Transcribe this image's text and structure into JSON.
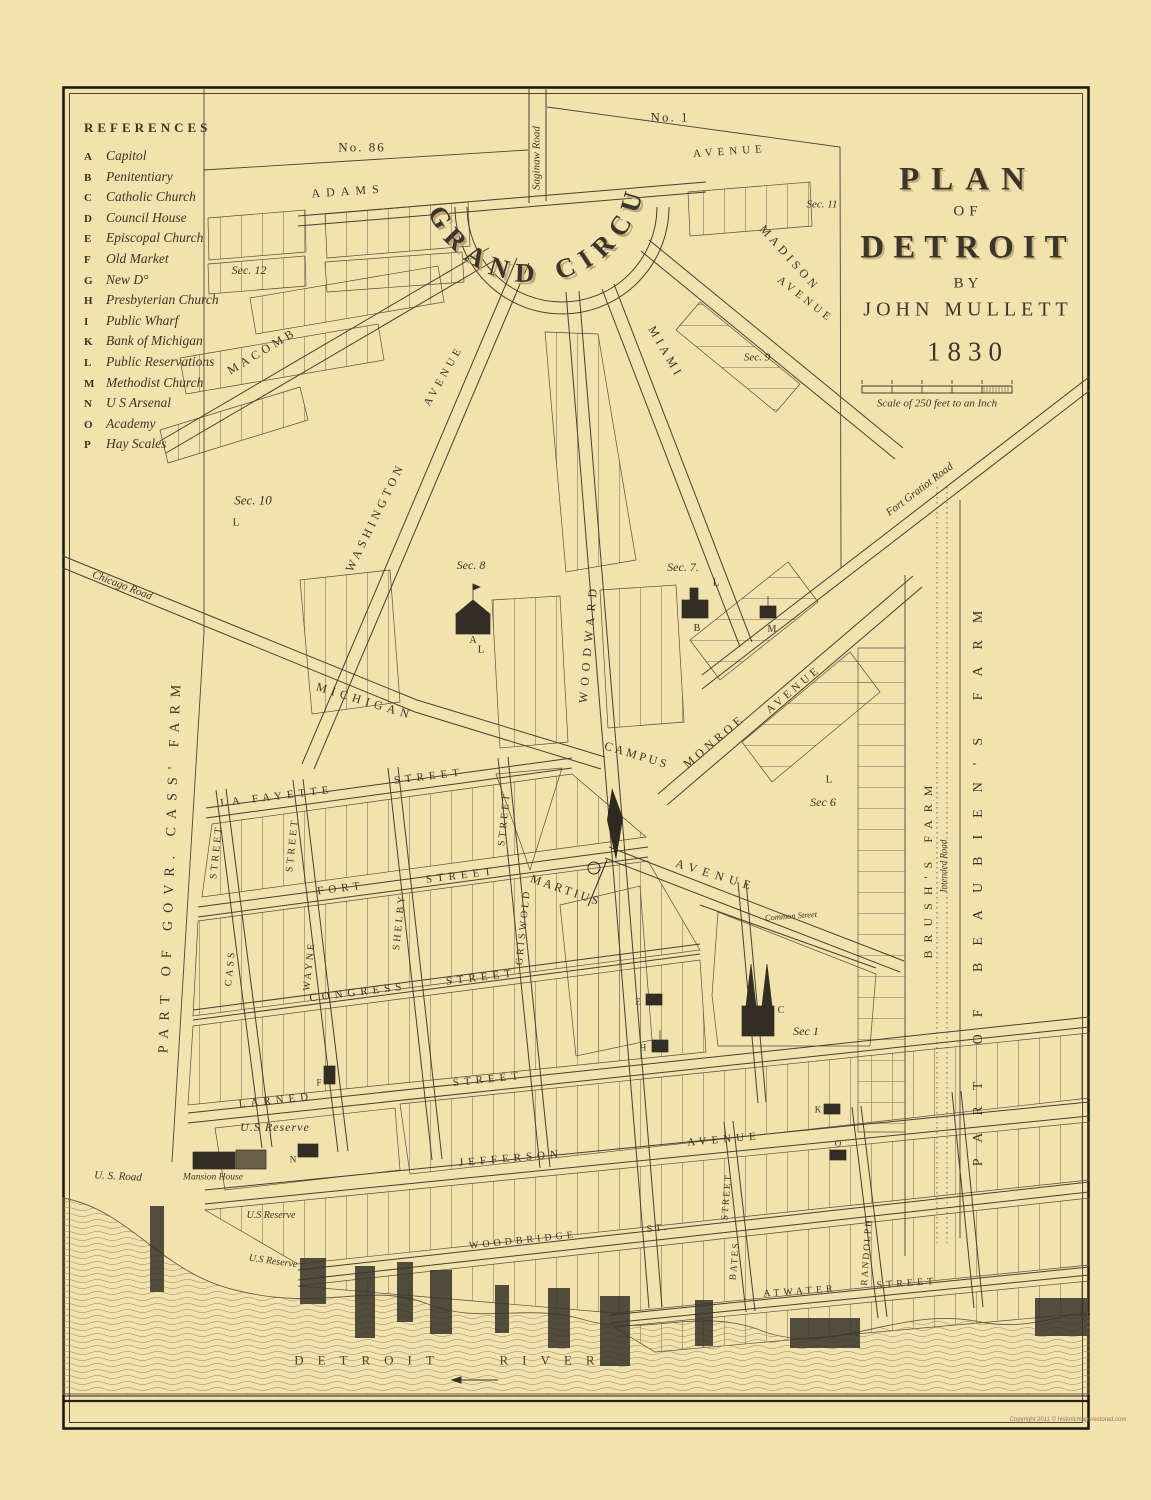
{
  "window": {
    "copyright": "Copyright 2011 © historicmapsrestored.com"
  },
  "title_block": {
    "plan": "PLAN",
    "of": "OF",
    "detroit": "DETROIT",
    "by": "BY",
    "author": "JOHN MULLETT",
    "year": "1830"
  },
  "scale": {
    "label": "Scale of 250 feet to an Inch"
  },
  "references": {
    "heading": "REFERENCES",
    "items": [
      {
        "key": "A",
        "label": "Capitol"
      },
      {
        "key": "B",
        "label": "Penitentiary"
      },
      {
        "key": "C",
        "label": "Catholic Church"
      },
      {
        "key": "D",
        "label": "Council House"
      },
      {
        "key": "E",
        "label": "Episcopal Church"
      },
      {
        "key": "F",
        "label": "Old Market"
      },
      {
        "key": "G",
        "label": "New D°"
      },
      {
        "key": "H",
        "label": "Presbyterian Church"
      },
      {
        "key": "I",
        "label": "Public Wharf"
      },
      {
        "key": "K",
        "label": "Bank of Michigan"
      },
      {
        "key": "L",
        "label": "Public Reservations"
      },
      {
        "key": "M",
        "label": "Methodist Church"
      },
      {
        "key": "N",
        "label": "U S Arsenal"
      },
      {
        "key": "O",
        "label": "Academy"
      },
      {
        "key": "P",
        "label": "Hay Scales"
      }
    ]
  },
  "map": {
    "grand_circus": "GRAND CIRCUS",
    "plats": {
      "no86": "No. 86",
      "no1": "No. 1"
    },
    "roads": {
      "saginaw": "Saginaw Road",
      "chicago": "Chicago Road",
      "fort_gratiot": "Fort Gratiot Road",
      "us_road": "U. S. Road",
      "intended": "Intended Road",
      "common": "Common Street"
    },
    "streets": {
      "adams": "ADAMS",
      "madison": "MADISON",
      "madison_avenue": "AVENUE",
      "macomb": "MACOMB",
      "miami": "MIAMI",
      "washington": "WASHINGTON",
      "washington_avenue": "AVENUE",
      "woodward": "WOODWARD",
      "michigan": "MICHIGAN",
      "monroe": "MONROE",
      "monroe_avenue": "AVENUE",
      "grand_avenue": "AVENUE",
      "top_avenue": "AVENUE",
      "lafayette": "LA FAYETTE",
      "fort": "FORT",
      "congress": "CONGRESS",
      "larned": "LARNED",
      "jefferson": "JEFFERSON",
      "jefferson_avenue": "AVENUE",
      "woodbridge": "WOODBRIDGE",
      "woodbridge_st": "ST.",
      "atwater": "ATWATER",
      "street": "STREET",
      "cass": "CASS",
      "wayne": "WAYNE",
      "shelby": "SHELBY",
      "griswold": "GRISWOLD",
      "bates": "BATES",
      "randolph": "RANDOLPH"
    },
    "sections": {
      "s12": "Sec. 12",
      "s11": "Sec. 11",
      "s10": "Sec. 10",
      "s9": "Sec. 9",
      "s8": "Sec. 8",
      "s7": "Sec. 7.",
      "s6": "Sec 6",
      "s1": "Sec 1"
    },
    "farms": {
      "cass": "PART OF GOVR. CASS' FARM",
      "brush": "BRUSH'S FARM",
      "beaubien": "PART OF BEAUBIEN'S FARM"
    },
    "places": {
      "campus": "CAMPUS",
      "martius": "MARTIUS",
      "us_reserve": "U.S Reserve",
      "mansion_house": "Mansion House",
      "detroit": "DETROIT",
      "river": "RIVER",
      "reservation": "L"
    },
    "building_marks": {
      "capitol": "A",
      "penitentiary": "B",
      "catholic": "C",
      "episcopal": "E",
      "presbyterian": "H",
      "bank": "K",
      "methodist": "M",
      "arsenal": "N",
      "academy": "O",
      "market": "F"
    }
  }
}
